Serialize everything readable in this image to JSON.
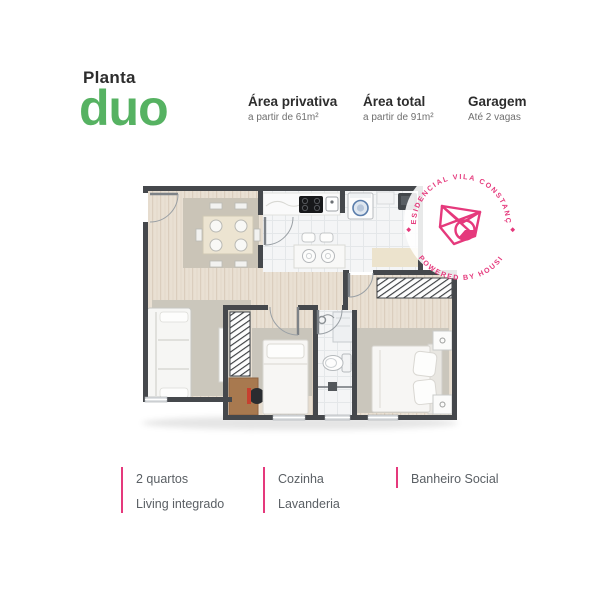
{
  "header": {
    "eyebrow": "Planta",
    "plan_name": "duo",
    "specs": [
      {
        "title": "Área privativa",
        "subtitle": "a partir de 61m²"
      },
      {
        "title": "Área total",
        "subtitle": "a partir de 91m²"
      },
      {
        "title": "Garagem",
        "subtitle": "Até 2 vagas"
      }
    ]
  },
  "stamp": {
    "arc_top": "RESIDENCIAL VILA CONSTANÇA",
    "arc_bottom": "POWERED BY HOUSI"
  },
  "features": [
    {
      "lines": [
        "2 quartos",
        "Living integrado"
      ]
    },
    {
      "lines": [
        "Cozinha",
        "Lavanderia"
      ]
    },
    {
      "lines": [
        "Banheiro Social"
      ]
    }
  ],
  "colors": {
    "brand_green": "#56b262",
    "brand_pink": "#e5397c",
    "heading_text": "#2d2d2d",
    "subtext": "#6f6f6f",
    "feature_text": "#5b6065",
    "wall": "#45484c",
    "wood_floor": "#e9e0d3",
    "tile_floor": "#f4f5f6"
  }
}
